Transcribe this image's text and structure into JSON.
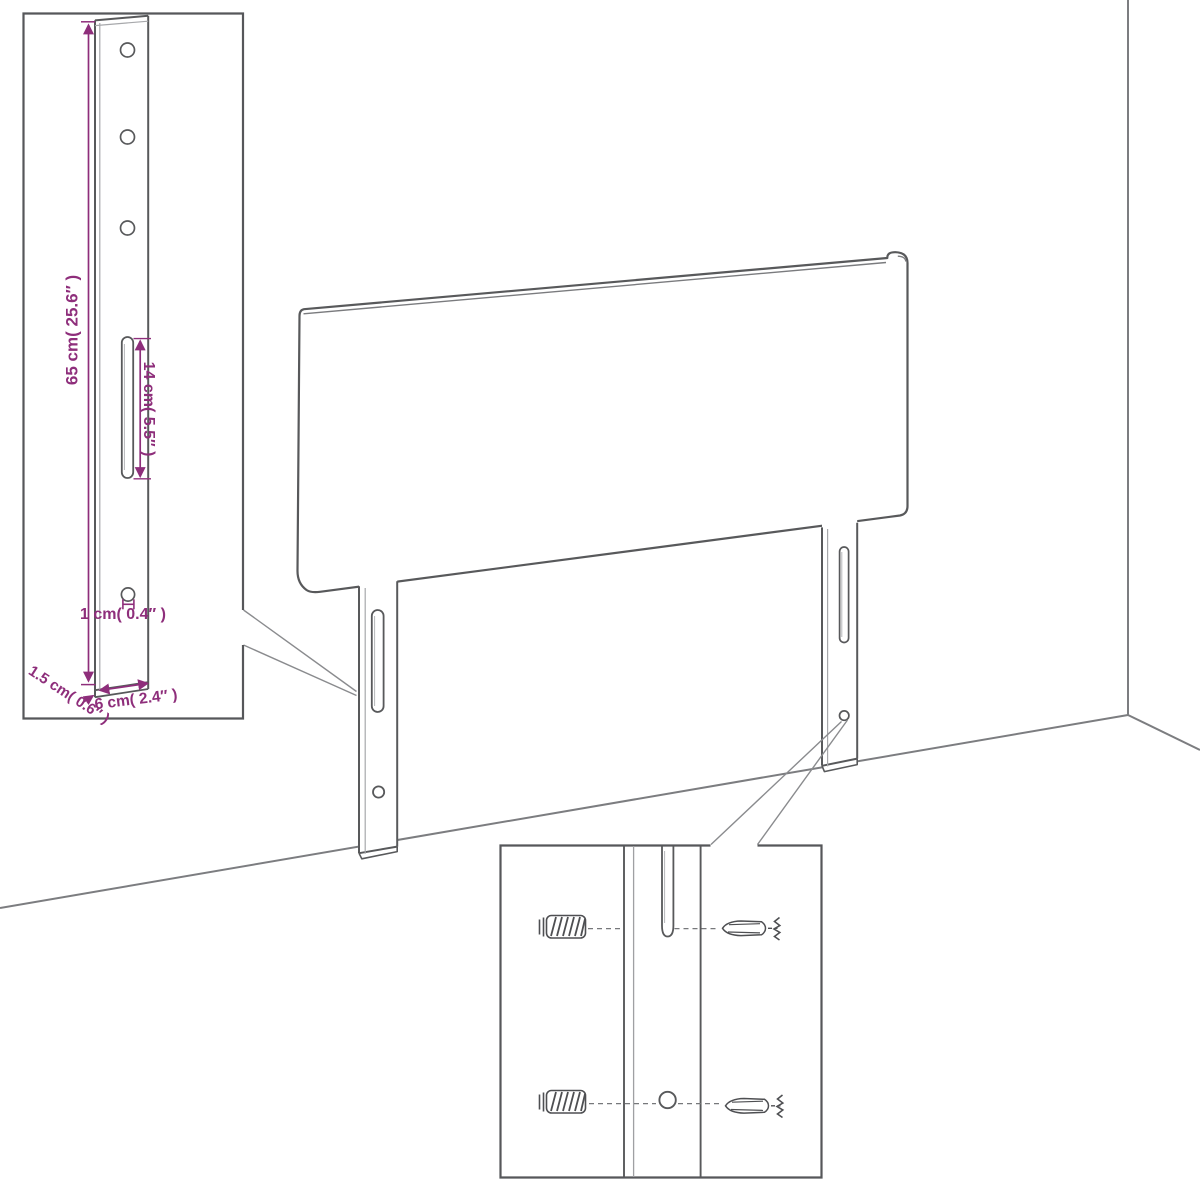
{
  "diagram": {
    "type": "furniture-assembly-technical-drawing",
    "subject": "headboard with mounting legs, wall installation detail",
    "colors": {
      "background": "#ffffff",
      "outline_gray": "#58595b",
      "room_gray": "#7c7d80",
      "hardware_gray": "#4e4f52",
      "dimension_magenta": "#8e2e7b"
    },
    "labels": {
      "leg_height": "65 cm( 25.6″ )",
      "slot_length": "14 cm( 5.5″ )",
      "hole_diameter": "1 cm( 0.4″ )",
      "leg_thickness": "1.5 cm( 0.6″ )",
      "leg_width": "6 cm( 2.4″ )"
    }
  }
}
